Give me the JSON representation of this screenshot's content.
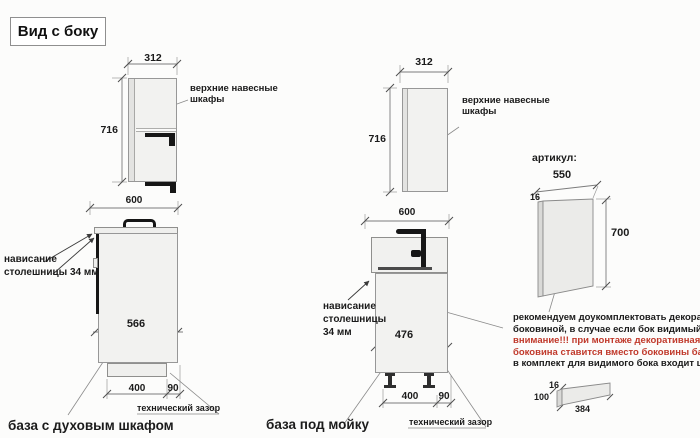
{
  "title": "Вид с боку",
  "colors": {
    "warning_red": "#c0392b",
    "line_gray": "#8c8c8c",
    "cabinet_fill": "#f2f2f0",
    "hardware_black": "#161616"
  },
  "units": {
    "oven": {
      "upper": {
        "width": "312",
        "height": "716",
        "label_line1": "верхние навесные",
        "label_line2": "шкафы"
      },
      "base": {
        "width": "600",
        "body_depth": "566",
        "plinth_depth": "400",
        "gap": "90",
        "overhang_line1": "нависание",
        "overhang_line2": "столешницы 34 мм",
        "gap_label": "технический зазор",
        "caption": "база с духовым шкафом"
      }
    },
    "sink": {
      "upper": {
        "width": "312",
        "height": "716",
        "label_line1": "верхние навесные",
        "label_line2": "шкафы"
      },
      "base": {
        "width": "600",
        "body_depth": "476",
        "plinth_depth": "400",
        "gap": "90",
        "overhang_line1": "нависание",
        "overhang_line2": "столешницы",
        "overhang_line3": "34 мм",
        "gap_label": "технический зазор",
        "caption": "база под мойку"
      }
    }
  },
  "article": {
    "heading": "артикул:",
    "panel": {
      "width": "550",
      "thickness": "16",
      "height": "700"
    },
    "note": {
      "line1": "рекомендуем доукомплектовать декоративной",
      "line2": "боковиной, в случае если бок видимый",
      "line3": "внимание!!! при монтаже декоративная",
      "line4": "боковина ставится вместо боковины базы лдсп",
      "line5": "в комплект для видимого бока входит цоколь:"
    },
    "plinth": {
      "thickness": "16",
      "height": "100",
      "length": "384"
    }
  }
}
